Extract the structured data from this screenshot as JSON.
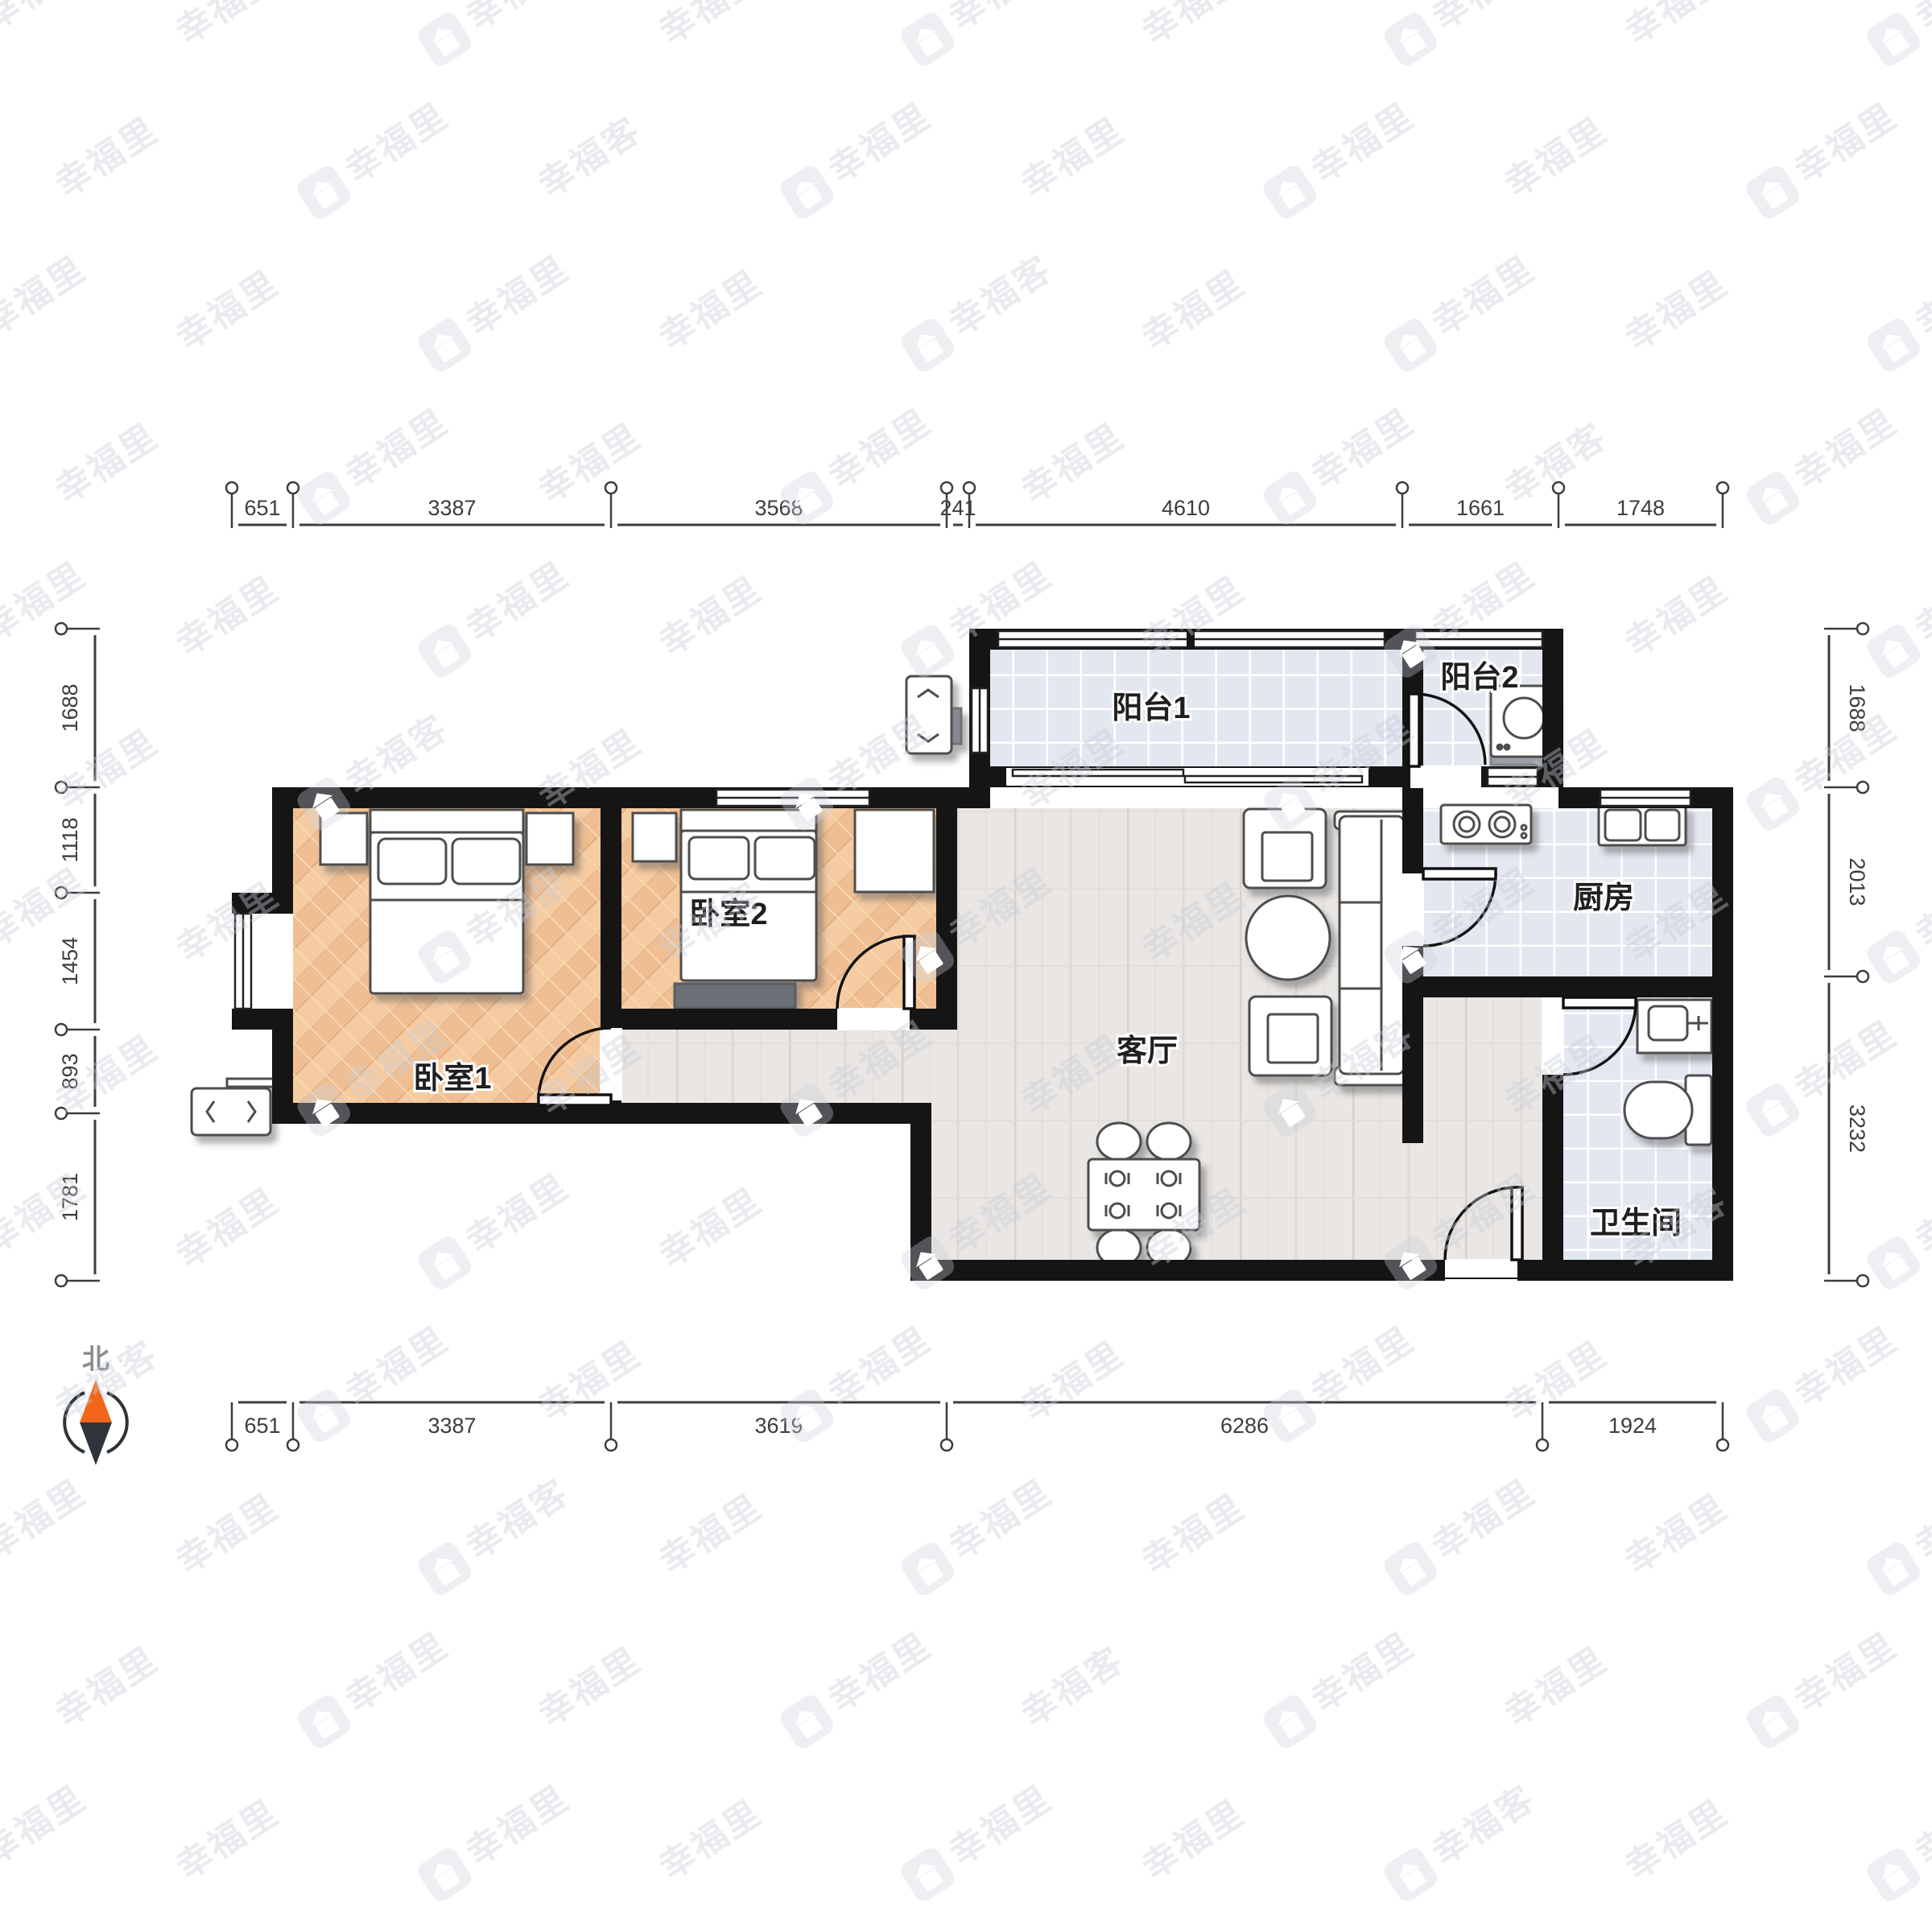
{
  "rooms": {
    "balcony1": {
      "label": "阳台1"
    },
    "balcony2": {
      "label": "阳台2"
    },
    "bedroom1": {
      "label": "卧室1"
    },
    "bedroom2": {
      "label": "卧室2"
    },
    "living_room": {
      "label": "客厅"
    },
    "kitchen": {
      "label": "厨房"
    },
    "bathroom": {
      "label": "卫生间"
    }
  },
  "dimensions_mm": {
    "top": [
      "651",
      "3387",
      "3568",
      "241",
      "4610",
      "1661",
      "1748"
    ],
    "bottom": [
      "651",
      "3387",
      "3619",
      "6286",
      "1924"
    ],
    "left": [
      "1688",
      "1118",
      "1454",
      "893",
      "1781"
    ],
    "right": [
      "1688",
      "2013",
      "3232"
    ]
  },
  "compass": {
    "north_label": "北"
  },
  "watermark": {
    "brand_primary": "幸福里",
    "brand_secondary": "幸福客"
  },
  "colors": {
    "wall": "#151515",
    "compass_north": "#f2661b",
    "compass_south": "#2f343a",
    "tile_floor": "#e3e7f0",
    "wood_floor": "#e9e6e3",
    "bedroom_floor": "#f4c79c",
    "watermark_gray": "#c7cdd6"
  }
}
